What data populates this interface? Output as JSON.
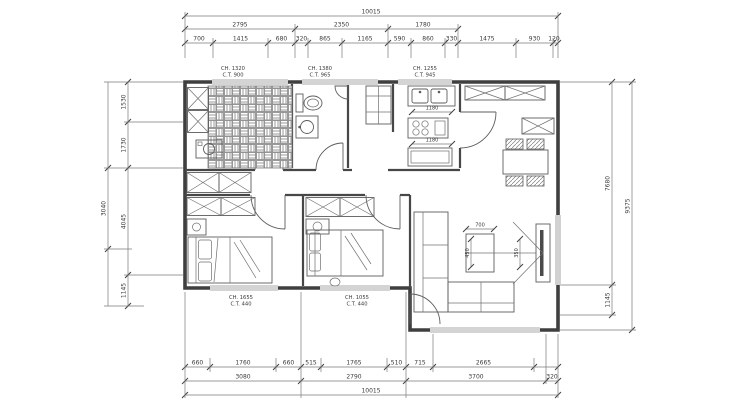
{
  "drawing": {
    "title": "apartment floor plan"
  },
  "dims": {
    "top": {
      "overall": "10015",
      "row2": [
        "2795",
        "2350",
        "1780"
      ],
      "row3": [
        "700",
        "1415",
        "680",
        "320",
        "865",
        "1165",
        "590",
        "860",
        "330",
        "1475",
        "930",
        "120"
      ]
    },
    "bottom": {
      "row1": [
        "660",
        "1760",
        "660",
        "515",
        "1765",
        "510",
        "715",
        "2665"
      ],
      "row2": [
        "3080",
        "2790",
        "3700",
        "320"
      ],
      "overall": "10015"
    },
    "left": {
      "outer": "3040",
      "inner": [
        "1530",
        "1730",
        "4045",
        "1145"
      ]
    },
    "right": {
      "inner": [
        "7680",
        "1145"
      ],
      "outer": "9375"
    }
  },
  "window_labels": {
    "top": [
      {
        "ch": "CH. 1320",
        "ct": "C.T. 900"
      },
      {
        "ch": "CH. 1380",
        "ct": "C.T. 965"
      },
      {
        "ch": "CH. 1255",
        "ct": "C.T. 945"
      }
    ],
    "bottom": [
      {
        "ch": "CH. 1655",
        "ct": "C.T. 440"
      },
      {
        "ch": "CH. 1055",
        "ct": "C.T. 440"
      }
    ]
  },
  "furniture_dims": {
    "kitchen_counter_top": "1180",
    "kitchen_counter_bottom": "1180",
    "coffee_table_width": "700",
    "coffee_table_depth": "450",
    "tv_clearance": "350"
  },
  "colors": {
    "line": "#3f3f3f",
    "dim_line": "#7a7a7a",
    "background": "#ffffff"
  }
}
